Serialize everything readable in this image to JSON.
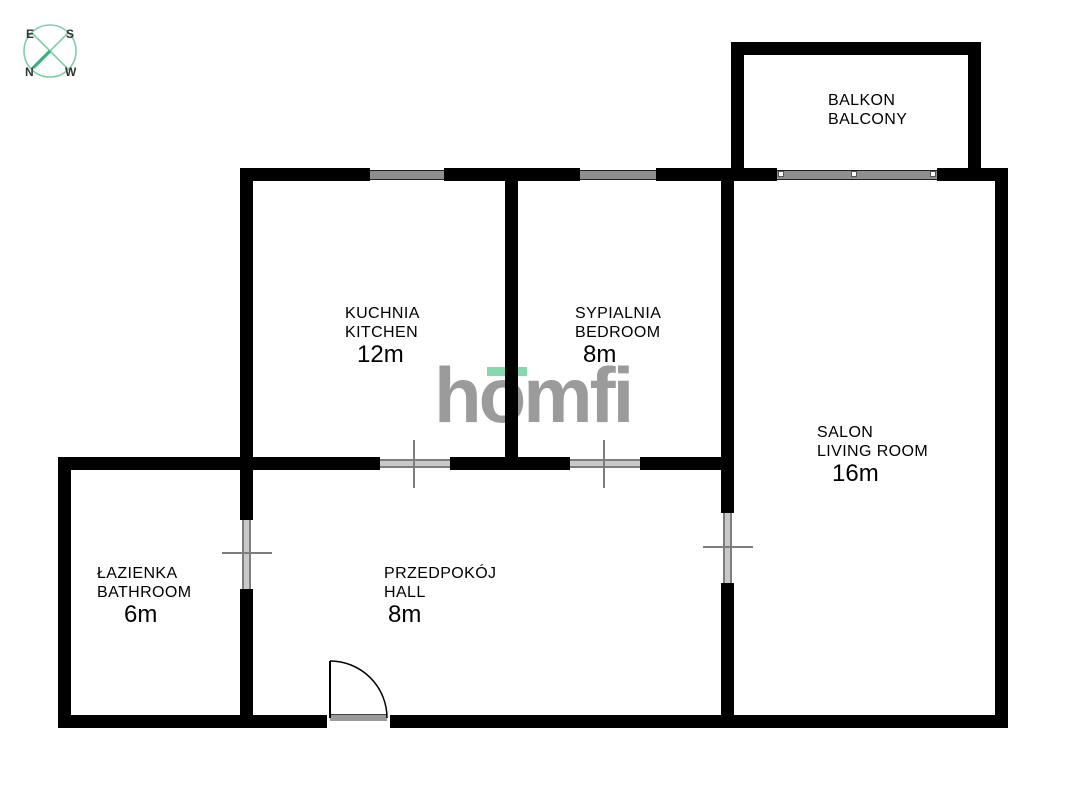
{
  "compass": {
    "top_left": "E",
    "top_right": "S",
    "bottom_left": "N",
    "bottom_right": "W"
  },
  "branding": {
    "logo_text": "homfi",
    "logo_color": "#9b9b9b",
    "accent_green": "#85d9ad",
    "compass_green": "#7ecfa7",
    "compass_needle_green": "#3fae7f"
  },
  "rooms": {
    "balcony": {
      "name_pl": "BALKON",
      "name_en": "BALCONY",
      "area": ""
    },
    "kitchen": {
      "name_pl": "KUCHNIA",
      "name_en": "KITCHEN",
      "area": "12m"
    },
    "bedroom": {
      "name_pl": "SYPIALNIA",
      "name_en": "BEDROOM",
      "area": "8m"
    },
    "living_room": {
      "name_pl": "SALON",
      "name_en": "LIVING ROOM",
      "area": "16m"
    },
    "bathroom": {
      "name_pl": "ŁAZIENKA",
      "name_en": "BATHROOM",
      "area": "6m"
    },
    "hall": {
      "name_pl": "PRZEDPOKÓJ",
      "name_en": "HALL",
      "area": "8m"
    }
  },
  "colors": {
    "wall": "#000000",
    "window": "#8f8f8f",
    "door_symbol": "#7d7d7d",
    "background": "#ffffff"
  }
}
